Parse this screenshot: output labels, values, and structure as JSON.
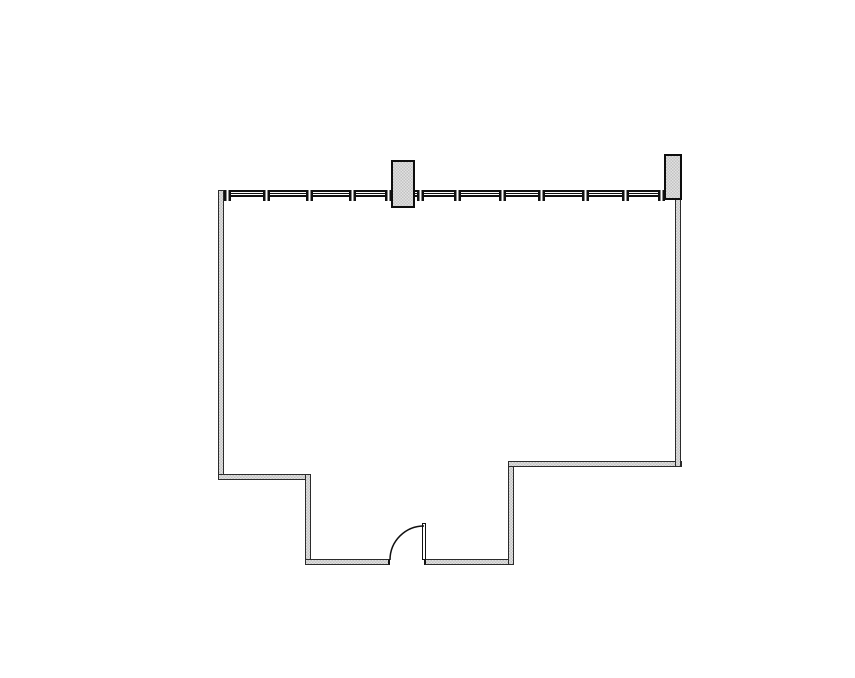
{
  "plan": {
    "type": "floor-plan",
    "description": "single-room floor plan with mullioned window wall, two columns, stepped lower walls and one swing door",
    "colors": {
      "background": "#ffffff",
      "line": "#111111",
      "wall_edge": "#2b2b2b",
      "wall_fill_dark": "#c2c2c2",
      "wall_fill_light": "#e2e2e2"
    },
    "window_wall": {
      "mullion_positions_x": [
        227,
        266,
        309,
        352,
        388,
        420,
        457,
        502,
        541,
        585,
        625,
        661
      ]
    },
    "columns": [
      {
        "id": "column-center"
      },
      {
        "id": "column-right"
      }
    ],
    "door": {
      "type": "single-swing",
      "swing": "quarter-arc"
    }
  }
}
